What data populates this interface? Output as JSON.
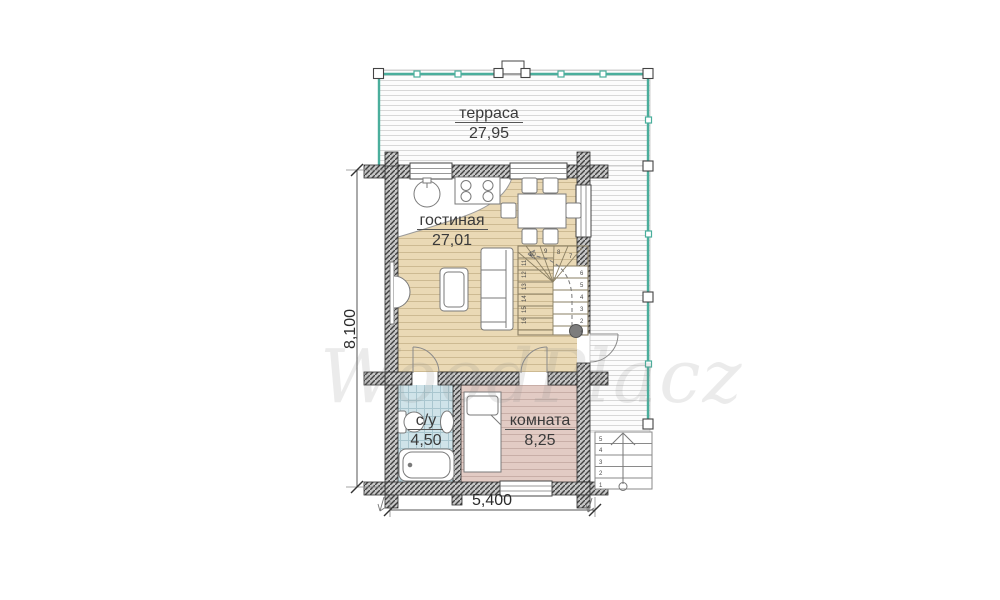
{
  "watermark": "WoodPlacz",
  "rooms": {
    "terrace": {
      "name": "терраса",
      "area": "27,95"
    },
    "living_room": {
      "name": "гостиная",
      "area": "27,01"
    },
    "bathroom": {
      "name": "с/у",
      "area": "4,50"
    },
    "bedroom": {
      "name": "комната",
      "area": "8,25"
    }
  },
  "dimensions": {
    "side": "8,100",
    "bottom": "5,400"
  },
  "stairs": {
    "interior": {
      "lower_flight": [
        "1",
        "2",
        "3",
        "4",
        "5",
        "6"
      ],
      "winders": [
        "7",
        "8",
        "9",
        "10"
      ],
      "upper_flight": [
        "11",
        "12",
        "13",
        "14",
        "15",
        "16"
      ]
    },
    "exterior": [
      "1",
      "2",
      "3",
      "4",
      "5"
    ]
  },
  "colors": {
    "railing_teal": "#4aae9c",
    "living_floor": "#ead9b5",
    "bedroom_floor": "#e2cbc4",
    "bathroom_floor": "#cfe3e9",
    "deck_line": "#d8d8d8",
    "wall_hatch": "#424242",
    "label_text": "#3a3a3a"
  }
}
